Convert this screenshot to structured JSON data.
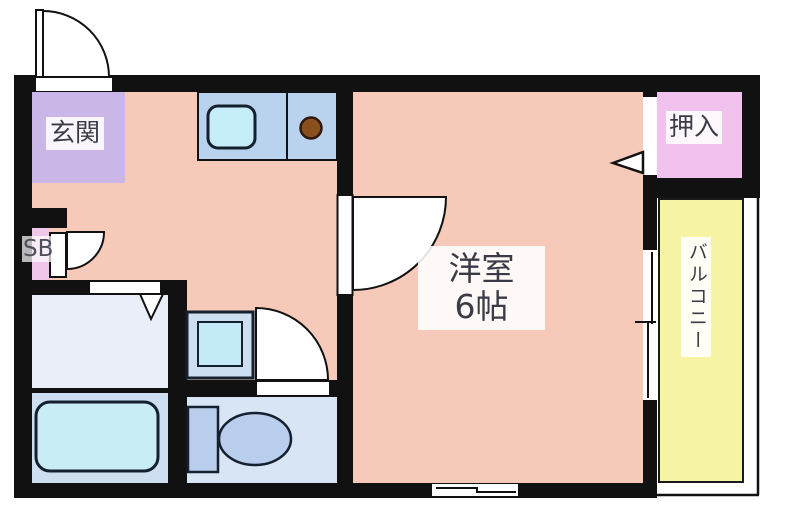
{
  "plan_type": "apartment-floor-plan",
  "rooms": {
    "entrance": {
      "label": "玄関"
    },
    "closet": {
      "label": "押入"
    },
    "western_room": {
      "name": "洋室",
      "size": "6帖"
    },
    "balcony": {
      "label": "バルコニー"
    },
    "shoe_box": {
      "label": "SB"
    }
  },
  "colors": {
    "wall": "#111111",
    "floor_main": "#f6c9b8",
    "entrance_floor": "#cbb6e8",
    "closet_floor": "#f2c2ee",
    "balcony_floor": "#f8f4a6",
    "washroom_floor": "#e9eef9",
    "bath_floor": "#cfdff2",
    "toilet_floor": "#d8e5f5",
    "kitchen_counter": "#b9d3ee",
    "sink": "#c5eef8",
    "burner": "#8a4f1d",
    "bathtub": "#c9edf5",
    "toilet_fixture": "#b9cdec",
    "label_text": "#3b3b47"
  }
}
